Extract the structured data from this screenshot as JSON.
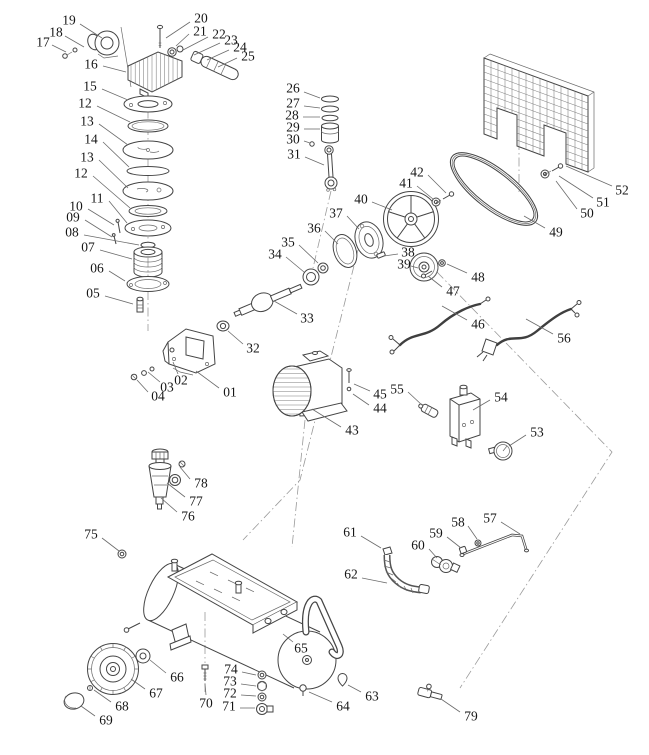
{
  "document": {
    "type": "exploded-parts-diagram",
    "subject": "air compressor assembly",
    "background": "#ffffff"
  },
  "colors": {
    "line": "#454545",
    "thin_line": "#6a6a6a",
    "label_text": "#161616",
    "leader_line": "#6b6b6b",
    "dash_line": "#9a9a9a"
  },
  "labels": [
    {
      "n": "17",
      "x": 43,
      "y": 42,
      "l": [
        52,
        45,
        66,
        52
      ]
    },
    {
      "n": "18",
      "x": 56,
      "y": 32,
      "l": [
        65,
        36,
        84,
        47
      ]
    },
    {
      "n": "19",
      "x": 69,
      "y": 20,
      "l": [
        80,
        24,
        102,
        38
      ]
    },
    {
      "n": "20",
      "x": 201,
      "y": 18,
      "l": [
        190,
        22,
        166,
        38
      ]
    },
    {
      "n": "21",
      "x": 200,
      "y": 31,
      "l": [
        189,
        34,
        176,
        46
      ]
    },
    {
      "n": "22",
      "x": 219,
      "y": 34,
      "l": [
        208,
        37,
        183,
        50
      ]
    },
    {
      "n": "23",
      "x": 231,
      "y": 40,
      "l": [
        220,
        43,
        194,
        55
      ]
    },
    {
      "n": "24",
      "x": 240,
      "y": 47,
      "l": [
        229,
        50,
        207,
        60
      ]
    },
    {
      "n": "25",
      "x": 248,
      "y": 56,
      "l": [
        237,
        58,
        218,
        67
      ]
    },
    {
      "n": "16",
      "x": 91,
      "y": 64,
      "l": [
        103,
        66,
        126,
        72
      ]
    },
    {
      "n": "15",
      "x": 90,
      "y": 86,
      "l": [
        102,
        89,
        128,
        100
      ]
    },
    {
      "n": "12",
      "x": 85,
      "y": 103,
      "l": [
        97,
        106,
        130,
        122
      ]
    },
    {
      "n": "13",
      "x": 87,
      "y": 121,
      "l": [
        99,
        124,
        128,
        145
      ]
    },
    {
      "n": "14",
      "x": 91,
      "y": 139,
      "l": [
        103,
        142,
        129,
        167
      ]
    },
    {
      "n": "13",
      "x": 87,
      "y": 157,
      "l": [
        99,
        160,
        128,
        188
      ]
    },
    {
      "n": "12",
      "x": 81,
      "y": 173,
      "l": [
        93,
        176,
        130,
        208
      ]
    },
    {
      "n": "11",
      "x": 97,
      "y": 198,
      "l": [
        109,
        201,
        127,
        223
      ]
    },
    {
      "n": "10",
      "x": 76,
      "y": 206,
      "l": [
        88,
        209,
        114,
        225
      ]
    },
    {
      "n": "09",
      "x": 73,
      "y": 217,
      "l": [
        85,
        220,
        112,
        237
      ]
    },
    {
      "n": "08",
      "x": 72,
      "y": 232,
      "l": [
        84,
        235,
        139,
        245
      ]
    },
    {
      "n": "07",
      "x": 88,
      "y": 247,
      "l": [
        100,
        250,
        132,
        259
      ]
    },
    {
      "n": "06",
      "x": 97,
      "y": 268,
      "l": [
        109,
        271,
        125,
        281
      ]
    },
    {
      "n": "05",
      "x": 93,
      "y": 293,
      "l": [
        105,
        296,
        133,
        304
      ]
    },
    {
      "n": "26",
      "x": 293,
      "y": 88,
      "l": [
        304,
        92,
        320,
        98
      ]
    },
    {
      "n": "27",
      "x": 293,
      "y": 103,
      "l": [
        304,
        106,
        320,
        108
      ]
    },
    {
      "n": "28",
      "x": 292,
      "y": 115,
      "l": [
        303,
        117,
        320,
        117
      ]
    },
    {
      "n": "29",
      "x": 293,
      "y": 127,
      "l": [
        304,
        129,
        320,
        129
      ]
    },
    {
      "n": "30",
      "x": 293,
      "y": 139,
      "l": [
        304,
        141,
        310,
        143
      ]
    },
    {
      "n": "31",
      "x": 294,
      "y": 154,
      "l": [
        305,
        157,
        324,
        165
      ]
    },
    {
      "n": "42",
      "x": 417,
      "y": 172,
      "l": [
        428,
        175,
        446,
        193
      ]
    },
    {
      "n": "41",
      "x": 406,
      "y": 183,
      "l": [
        417,
        186,
        433,
        199
      ]
    },
    {
      "n": "40",
      "x": 361,
      "y": 199,
      "l": [
        372,
        202,
        392,
        210
      ]
    },
    {
      "n": "37",
      "x": 336,
      "y": 213,
      "l": [
        347,
        216,
        359,
        229
      ]
    },
    {
      "n": "36",
      "x": 314,
      "y": 228,
      "l": [
        325,
        231,
        338,
        244
      ]
    },
    {
      "n": "35",
      "x": 288,
      "y": 242,
      "l": [
        299,
        245,
        318,
        263
      ]
    },
    {
      "n": "34",
      "x": 275,
      "y": 254,
      "l": [
        286,
        257,
        304,
        272
      ]
    },
    {
      "n": "38",
      "x": 408,
      "y": 252,
      "l": [
        398,
        254,
        384,
        256
      ]
    },
    {
      "n": "39",
      "x": 404,
      "y": 264,
      "l": [
        411,
        266,
        418,
        268
      ]
    },
    {
      "n": "33",
      "x": 307,
      "y": 318,
      "l": [
        297,
        314,
        274,
        301
      ]
    },
    {
      "n": "32",
      "x": 253,
      "y": 348,
      "l": [
        243,
        344,
        228,
        331
      ]
    },
    {
      "n": "49",
      "x": 556,
      "y": 232,
      "l": [
        545,
        228,
        524,
        216
      ]
    },
    {
      "n": "50",
      "x": 587,
      "y": 213,
      "l": [
        577,
        209,
        556,
        181
      ]
    },
    {
      "n": "51",
      "x": 603,
      "y": 202,
      "l": [
        593,
        198,
        559,
        176
      ]
    },
    {
      "n": "52",
      "x": 622,
      "y": 190,
      "l": [
        612,
        186,
        566,
        166
      ]
    },
    {
      "n": "48",
      "x": 478,
      "y": 277,
      "l": [
        467,
        273,
        447,
        264
      ]
    },
    {
      "n": "47",
      "x": 453,
      "y": 291,
      "l": [
        442,
        287,
        428,
        276
      ]
    },
    {
      "n": "46",
      "x": 478,
      "y": 324,
      "l": [
        467,
        320,
        442,
        306
      ]
    },
    {
      "n": "56",
      "x": 564,
      "y": 338,
      "l": [
        553,
        334,
        526,
        319
      ]
    },
    {
      "n": "45",
      "x": 380,
      "y": 394,
      "l": [
        370,
        391,
        354,
        384
      ]
    },
    {
      "n": "55",
      "x": 397,
      "y": 389,
      "l": [
        408,
        392,
        423,
        406
      ]
    },
    {
      "n": "44",
      "x": 380,
      "y": 408,
      "l": [
        369,
        405,
        353,
        394
      ]
    },
    {
      "n": "43",
      "x": 352,
      "y": 430,
      "l": [
        341,
        427,
        312,
        409
      ]
    },
    {
      "n": "54",
      "x": 501,
      "y": 397,
      "l": [
        490,
        400,
        473,
        410
      ]
    },
    {
      "n": "53",
      "x": 537,
      "y": 432,
      "l": [
        526,
        435,
        509,
        446
      ]
    },
    {
      "n": "02",
      "x": 181,
      "y": 380,
      "l": [
        178,
        374,
        173,
        362
      ]
    },
    {
      "n": "03",
      "x": 167,
      "y": 387,
      "l": [
        160,
        382,
        148,
        372
      ]
    },
    {
      "n": "04",
      "x": 158,
      "y": 396,
      "l": [
        148,
        392,
        137,
        380
      ]
    },
    {
      "n": "01",
      "x": 230,
      "y": 392,
      "l": [
        219,
        388,
        196,
        371
      ]
    },
    {
      "n": "78",
      "x": 201,
      "y": 483,
      "l": [
        190,
        479,
        180,
        467
      ]
    },
    {
      "n": "77",
      "x": 196,
      "y": 501,
      "l": [
        185,
        497,
        167,
        483
      ]
    },
    {
      "n": "76",
      "x": 188,
      "y": 516,
      "l": [
        177,
        512,
        161,
        498
      ]
    },
    {
      "n": "75",
      "x": 91,
      "y": 534,
      "l": [
        102,
        538,
        119,
        551
      ]
    },
    {
      "n": "61",
      "x": 350,
      "y": 532,
      "l": [
        361,
        536,
        381,
        548
      ]
    },
    {
      "n": "57",
      "x": 490,
      "y": 518,
      "l": [
        501,
        522,
        520,
        534
      ]
    },
    {
      "n": "58",
      "x": 458,
      "y": 522,
      "l": [
        468,
        526,
        477,
        539
      ]
    },
    {
      "n": "59",
      "x": 436,
      "y": 533,
      "l": [
        447,
        537,
        461,
        548
      ]
    },
    {
      "n": "60",
      "x": 418,
      "y": 545,
      "l": [
        429,
        549,
        437,
        558
      ]
    },
    {
      "n": "62",
      "x": 351,
      "y": 574,
      "l": [
        362,
        578,
        387,
        583
      ]
    },
    {
      "n": "65",
      "x": 301,
      "y": 648,
      "l": [
        293,
        642,
        283,
        634
      ]
    },
    {
      "n": "63",
      "x": 372,
      "y": 696,
      "l": [
        361,
        692,
        348,
        685
      ]
    },
    {
      "n": "64",
      "x": 343,
      "y": 706,
      "l": [
        332,
        702,
        309,
        692
      ]
    },
    {
      "n": "66",
      "x": 177,
      "y": 677,
      "l": [
        166,
        673,
        150,
        660
      ]
    },
    {
      "n": "67",
      "x": 156,
      "y": 693,
      "l": [
        145,
        689,
        131,
        679
      ]
    },
    {
      "n": "68",
      "x": 122,
      "y": 706,
      "l": [
        111,
        702,
        94,
        690
      ]
    },
    {
      "n": "69",
      "x": 106,
      "y": 720,
      "l": [
        95,
        716,
        81,
        706
      ]
    },
    {
      "n": "70",
      "x": 206,
      "y": 703,
      "l": [
        206,
        695,
        205,
        684
      ]
    },
    {
      "n": "74",
      "x": 231,
      "y": 669,
      "l": [
        242,
        672,
        256,
        675
      ]
    },
    {
      "n": "73",
      "x": 230,
      "y": 681,
      "l": [
        241,
        684,
        256,
        686
      ]
    },
    {
      "n": "72",
      "x": 230,
      "y": 693,
      "l": [
        241,
        695,
        256,
        696
      ]
    },
    {
      "n": "71",
      "x": 229,
      "y": 706,
      "l": [
        240,
        708,
        255,
        708
      ]
    },
    {
      "n": "79",
      "x": 471,
      "y": 716,
      "l": [
        460,
        712,
        441,
        699
      ]
    }
  ]
}
